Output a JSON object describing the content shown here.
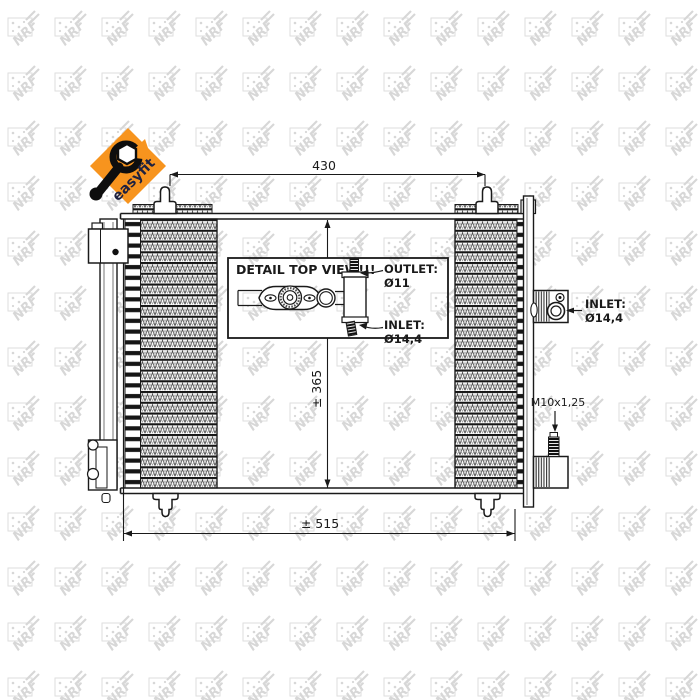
{
  "badge": {
    "label": "easyfit",
    "bg": "#F7941E",
    "fg": "#1d2140"
  },
  "watermark": {
    "brand": "NRF",
    "color": "#d7d7d7"
  },
  "dimensions": {
    "top_width": "430",
    "core_height": "± 365",
    "overall_width": "± 515"
  },
  "detail_inset": {
    "title": "DETAIL TOP VIEW!!!",
    "outlet_label": "OUTLET:",
    "outlet_size": "Ø11",
    "inlet_label": "INLET:",
    "inlet_size": "Ø14,4"
  },
  "connections": {
    "inlet_label": "INLET:",
    "inlet_size": "Ø14,4",
    "service_port_label": "M10x1,25"
  },
  "colors": {
    "line": "#1a1a1a",
    "accent": "#F7941E"
  }
}
